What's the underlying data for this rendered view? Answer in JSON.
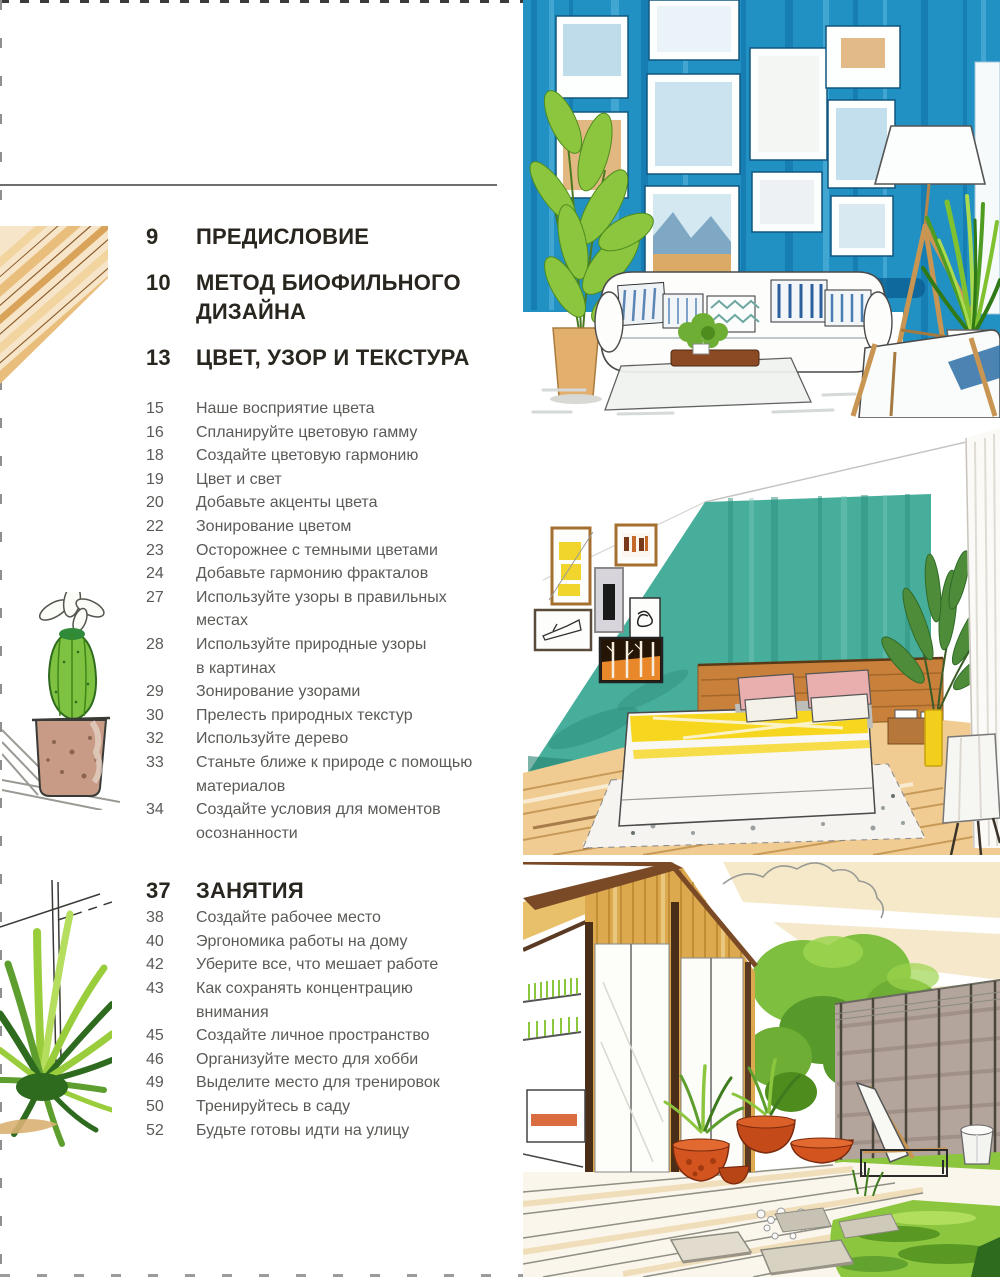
{
  "toc": {
    "sections": [
      {
        "number": "9",
        "title": "ПРЕДИСЛОВИЕ",
        "items": []
      },
      {
        "number": "10",
        "title": "МЕТОД БИОФИЛЬНОГО\nДИЗАЙНА",
        "items": []
      },
      {
        "number": "13",
        "title": "ЦВЕТ, УЗОР И ТЕКСТУРА",
        "items": [
          {
            "number": "15",
            "title": "Наше восприятие цвета"
          },
          {
            "number": "16",
            "title": "Спланируйте цветовую гамму"
          },
          {
            "number": "18",
            "title": "Создайте цветовую гармонию"
          },
          {
            "number": "19",
            "title": "Цвет и свет"
          },
          {
            "number": "20",
            "title": "Добавьте акценты цвета"
          },
          {
            "number": "22",
            "title": "Зонирование цветом"
          },
          {
            "number": "23",
            "title": "Осторожнее с темными цветами"
          },
          {
            "number": "24",
            "title": "Добавьте гармонию фракталов"
          },
          {
            "number": "27",
            "title": "Используйте узоры в правильных\nместах"
          },
          {
            "number": "28",
            "title": "Используйте природные узоры\nв картинах"
          },
          {
            "number": "29",
            "title": "Зонирование узорами"
          },
          {
            "number": "30",
            "title": "Прелесть природных текстур"
          },
          {
            "number": "32",
            "title": "Используйте дерево"
          },
          {
            "number": "33",
            "title": "Станьте ближе к природе с помощью\nматериалов"
          },
          {
            "number": "34",
            "title": "Создайте условия для моментов\nосознанности"
          }
        ]
      },
      {
        "number": "37",
        "title": "ЗАНЯТИЯ",
        "items": [
          {
            "number": "38",
            "title": "Создайте рабочее место"
          },
          {
            "number": "40",
            "title": "Эргономика работы на дому"
          },
          {
            "number": "42",
            "title": "Уберите все, что мешает работе"
          },
          {
            "number": "43",
            "title": "Как сохранять концентрацию\nвнимания"
          },
          {
            "number": "45",
            "title": "Создайте личное пространство"
          },
          {
            "number": "46",
            "title": "Организуйте место для хобби"
          },
          {
            "number": "49",
            "title": "Выделите место для тренировок"
          },
          {
            "number": "50",
            "title": "Тренируйтесь в саду"
          },
          {
            "number": "52",
            "title": "Будьте готовы идти на улицу"
          }
        ]
      }
    ]
  },
  "illustrations": {
    "living_room": {
      "label": "Marker sketch: living room with blue plank wall, gallery frames, white sofa, floor lamp and plants"
    },
    "bedroom": {
      "label": "Marker sketch: bedroom with teal accent wall, picture frames, wooden headboard and yellow striped bed"
    },
    "patio": {
      "label": "Marker sketch: wooden house terrace with potted plants, lounge chair, stone fence and garden pond"
    },
    "wood_swatch": {
      "label": "Wood grain texture sketch"
    },
    "cactus": {
      "label": "Potted cactus sketch on shelf"
    },
    "yucca": {
      "label": "Spiky houseplant sketch"
    }
  },
  "palette": {
    "wall_blue": "#2191C4",
    "wall_teal": "#47AE9C",
    "wood_tan": "#DCA94F",
    "leaf_green": "#8CC63F",
    "terracotta": "#D4541F",
    "accent_yellow": "#F6D61F",
    "heading_text": "#29251F",
    "body_text": "#5A5A57",
    "border_gray": "#8F8F8F",
    "background": "#FFFFFF"
  }
}
